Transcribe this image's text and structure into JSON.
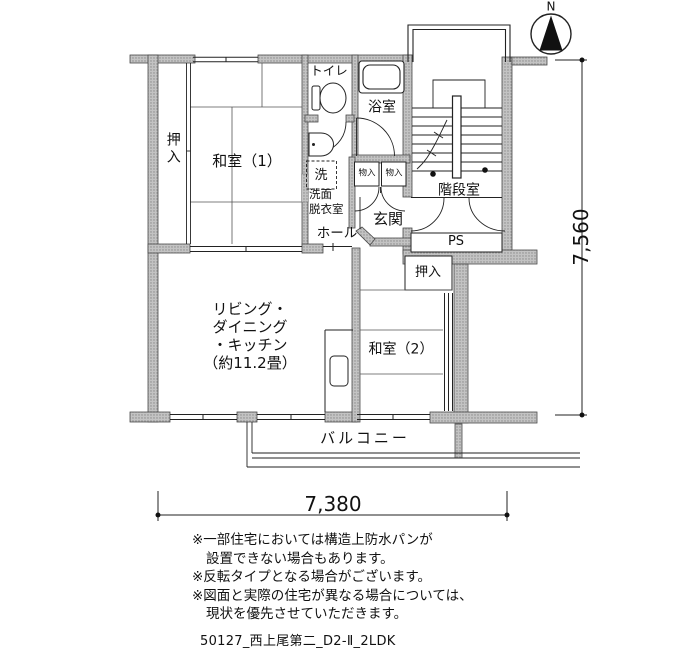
{
  "labels": {
    "washitsu1": "和室（1）",
    "oshiire1": "押入",
    "toilet": "トイレ",
    "bath": "浴室",
    "washer": "洗",
    "senmen_line1": "洗面",
    "senmen_line2": "脱衣室",
    "storage1": "物入",
    "storage2": "物入",
    "genkan": "玄関",
    "hall": "ホール",
    "stairwell": "階段室",
    "pipe_space": "PS",
    "oshiire2": "押入",
    "washitsu2": "和室（2）",
    "balcony": "バルコニー",
    "ldk_line1": "リビング・",
    "ldk_line2": "ダイニング",
    "ldk_line3": "・キッチン",
    "ldk_line4": "（約11.2畳）",
    "compass_north": "N"
  },
  "dimensions": {
    "horizontal": "7,380",
    "vertical": "7,560"
  },
  "notes": [
    "※一部住宅においては構造上防水パンが",
    "設置できない場合もあります。",
    "※反転タイプとなる場合がございます。",
    "※図面と実際の住宅が異なる場合については、",
    "現状を優先させていただきます。"
  ],
  "footer": "50127_西上尾第二_D2-Ⅱ_2LDK"
}
